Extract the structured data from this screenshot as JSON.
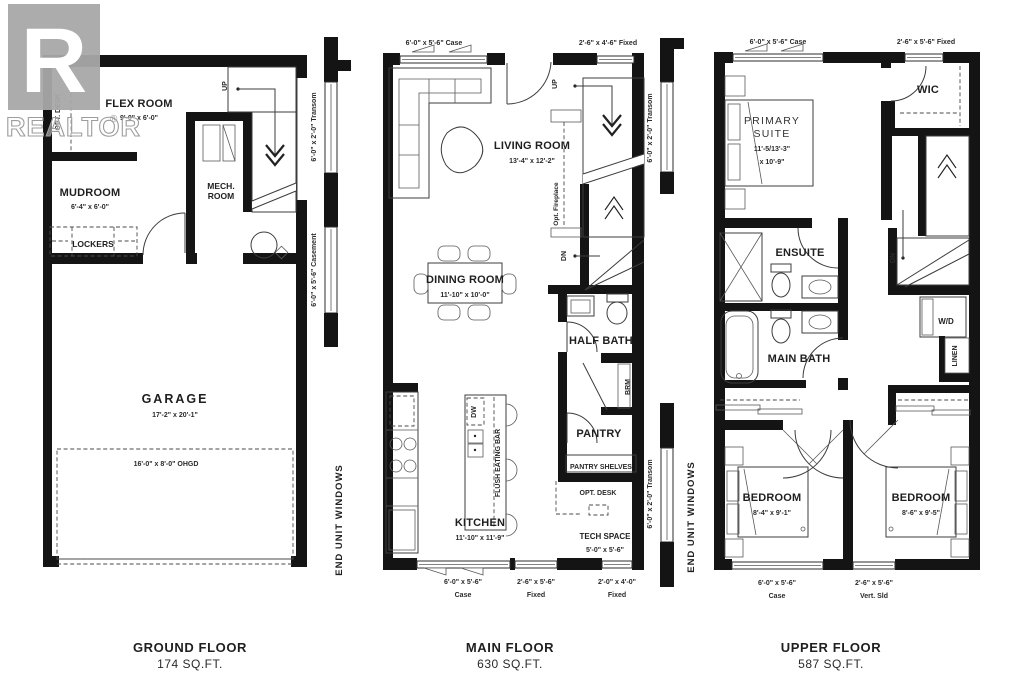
{
  "watermark": {
    "logo_letter": "R",
    "text": "REALTOR",
    "reg": "®"
  },
  "ground": {
    "title": "GROUND FLOOR",
    "area": "174 SQ.FT.",
    "flex": "FLEX ROOM",
    "flex_dims": "9'-0\" x 6'-0\"",
    "opt_desk": "OPT. DESK",
    "mudroom": "MUDROOM",
    "mudroom_dims": "6'-4\" x 6'-0\"",
    "lockers": "LOCKERS",
    "mech1": "MECH.",
    "mech2": "ROOM",
    "up": "UP",
    "garage": "GARAGE",
    "garage_dims": "17'-2\" x 20'-1\"",
    "ohgd": "16'-0\" x 8'-0\" OHGD",
    "transom": "6'-0\" x 2'-0\" Transom",
    "casement": "6'-0\" x 5'-6\" Casement",
    "end_unit": "END UNIT WINDOWS"
  },
  "main": {
    "title": "MAIN FLOOR",
    "area": "630 SQ.FT.",
    "win_top_left": "6'-0\" x 5'-6\" Case",
    "win_top_right": "2'-6\" x 4'-6\" Fixed",
    "living": "LIVING ROOM",
    "living_dims": "13'-4\" x 12'-2\"",
    "opt_fireplace": "Opt. Fireplace",
    "up": "UP",
    "dn": "DN",
    "dining": "DINING ROOM",
    "dining_dims": "11'-10\" x 10'-0\"",
    "half_bath": "HALF BATH",
    "brm": "BRM",
    "pantry": "PANTRY",
    "pantry_shelves": "PANTRY SHELVES",
    "opt_desk": "OPT. DESK",
    "tech": "TECH SPACE",
    "tech_dims": "5'-0\" x 5'-6\"",
    "kitchen": "KITCHEN",
    "kitchen_dims": "11'-10\" x 11'-9\"",
    "dw": "DW",
    "flush_bar": "FLUSH EATING BAR",
    "win_b1": "6'-0\" x 5'-6\"",
    "win_b1_type": "Case",
    "win_b2": "2'-6\" x 5'-6\"",
    "win_b2_type": "Fixed",
    "win_b3": "2'-0\" x 4'-0\"",
    "win_b3_type": "Fixed",
    "transom_upper": "6'-0\" x 2'-0\" Transom",
    "transom_lower": "6'-0\" x 2'-0\" Transom",
    "end_unit": "END UNIT WINDOWS"
  },
  "upper": {
    "title": "UPPER FLOOR",
    "area": "587 SQ.FT.",
    "win_top_left": "6'-0\" x 5'-6\" Case",
    "win_top_right": "2'-6\" x 5'-6\" Fixed",
    "primary1": "PRIMARY",
    "primary2": "SUITE",
    "primary_dims1": "11'-5/13'-3\"",
    "primary_dims2": "x 10'-9\"",
    "wic": "WIC",
    "ensuite": "ENSUITE",
    "main_bath": "MAIN BATH",
    "dn": "DN",
    "wd": "W/D",
    "linen": "LINEN",
    "bedroom_left": "BEDROOM",
    "bedroom_left_dims": "8'-4\" x 9'-1\"",
    "bedroom_right": "BEDROOM",
    "bedroom_right_dims": "8'-6\" x 9'-5\"",
    "win_b1": "6'-0\" x 5'-6\"",
    "win_b1_type": "Case",
    "win_b2": "2'-6\" x 5'-6\"",
    "win_b2_type": "Vert. Sld"
  }
}
